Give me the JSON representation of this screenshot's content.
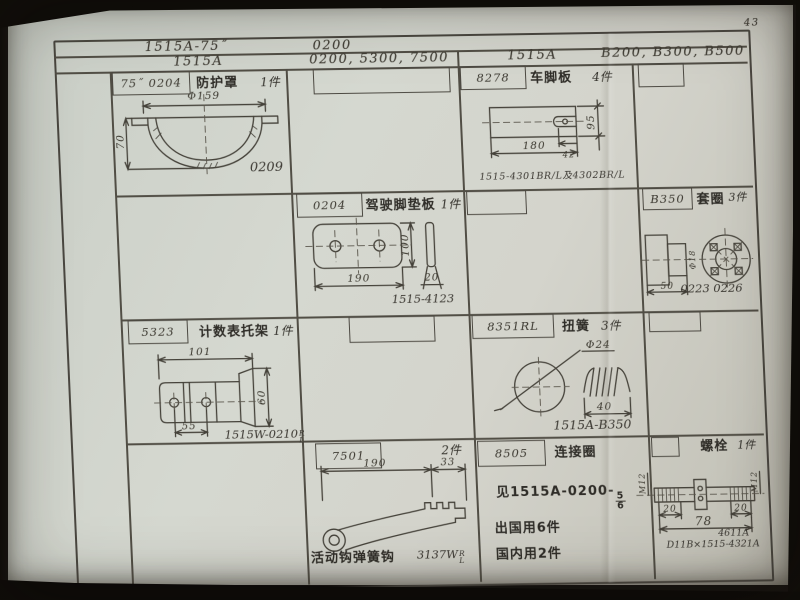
{
  "page_number": "43",
  "header": {
    "model_a": "1515A-75˝",
    "model_b": "0200",
    "model_c": "1515A",
    "model_d": "0200, 5300, 7500",
    "model_e": "1515A",
    "model_f": "B200, B300, B500"
  },
  "cells": {
    "guard": {
      "part_no": "75˝ 0204",
      "title": "防护罩",
      "qty": "1件",
      "dim_dia": "Φ159",
      "dim_h": "70",
      "ref": "0209"
    },
    "footplate": {
      "part_no": "8278",
      "title": "车脚板",
      "qty": "4件",
      "dim_w": "180",
      "dim_h": "95",
      "dim_slot": "42",
      "ref": "1515-4301BR/L及4302BR/L"
    },
    "pedal": {
      "part_no": "0204",
      "title": "驾驶脚垫板",
      "qty": "1件",
      "dim_w": "190",
      "dim_h": "100",
      "dim_t": "20",
      "ref": "1515-4123"
    },
    "sleeve": {
      "part_no": "B350",
      "title": "套圈",
      "qty": "3件",
      "dim_l": "50",
      "dim_dia": "Φ18",
      "ref": "0223 0226"
    },
    "bracket": {
      "part_no": "5323",
      "title": "计数表托架",
      "qty": "1件",
      "dim_l": "101",
      "dim_c": "55",
      "dim_h": "60",
      "ref": "1515W-0210",
      "ref_r": "R",
      "ref_l": "L"
    },
    "spring": {
      "part_no": "8351RL",
      "title": "扭簧",
      "qty": "3件",
      "dim_dia": "Φ24",
      "dim_l": "40",
      "ref": "1515A-B350"
    },
    "lever": {
      "part_no": "7501",
      "qty": "2件",
      "dim_l": "190",
      "dim_e": "33",
      "caption": "活动钩弹簧钩",
      "ref": "3137W",
      "ref_r": "R",
      "ref_l": "L"
    },
    "ring": {
      "part_no": "8505",
      "title": "连接圈",
      "see": "见1515A-0200-",
      "frac_top": "5",
      "frac_bot": "6",
      "note1": "出国用6件",
      "note2": "国内用2件"
    },
    "bolt": {
      "title": "螺栓",
      "qty": "1件",
      "thread_l": "M12",
      "thread_r": "M12",
      "dim_l": "20",
      "dim_r": "20",
      "dim_total": "78",
      "ref_top": "4611A",
      "ref_bot": "D11B×1515-4321A"
    }
  }
}
